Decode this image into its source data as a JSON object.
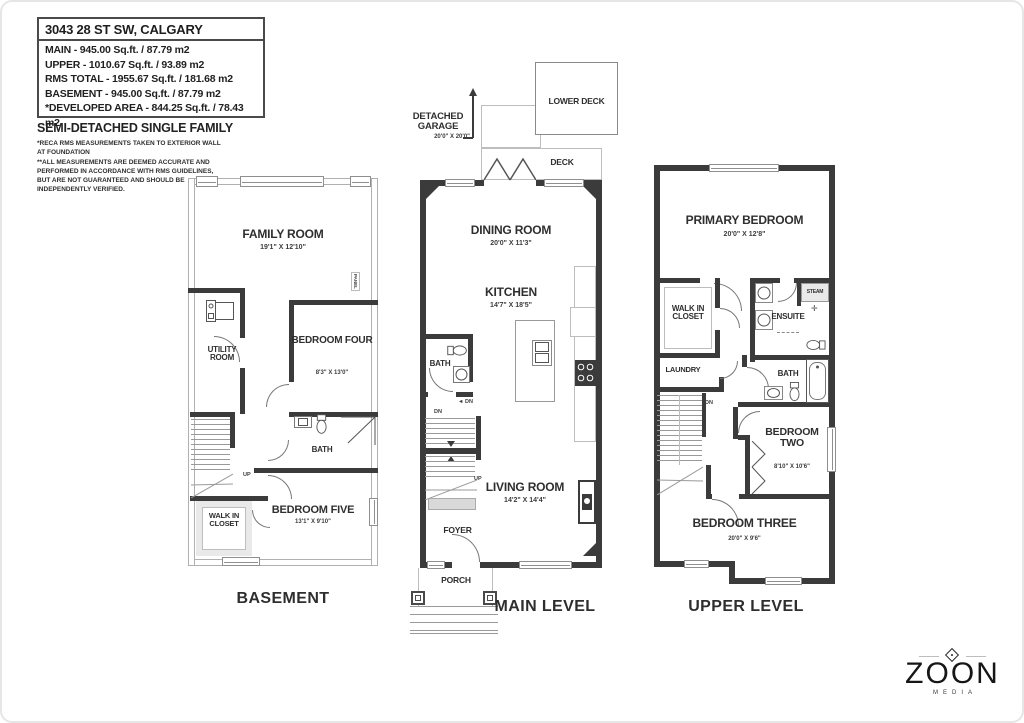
{
  "header": {
    "address": "3043 28 ST SW, CALGARY",
    "area_lines": [
      "MAIN - 945.00 Sq.ft. / 87.79 m2",
      "UPPER - 1010.67 Sq.ft. / 93.89 m2",
      "RMS TOTAL - 1955.67 Sq.ft. / 181.68 m2",
      "BASEMENT - 945.00 Sq.ft. / 87.79 m2",
      "*DEVELOPED AREA - 844.25 Sq.ft. / 78.43 m2"
    ],
    "property_type": "SEMI-DETACHED SINGLE FAMILY",
    "disclaimer_lines": [
      "*RECA RMS MEASUREMENTS TAKEN TO EXTERIOR WALL",
      "AT FOUNDATION",
      "**ALL MEASUREMENTS ARE DEEMED ACCURATE AND",
      "PERFORMED IN ACCORDANCE WITH RMS GUIDELINES,",
      "BUT ARE NOT GUARANTEED AND SHOULD BE",
      "INDEPENDENTLY VERIFIED."
    ]
  },
  "basement": {
    "label": "BASEMENT",
    "family_room": {
      "name": "FAMILY ROOM",
      "dims": "19'1\" X 12'10\""
    },
    "utility_room": {
      "name": "UTILITY ROOM"
    },
    "bedroom_four": {
      "name": "BEDROOM FOUR",
      "dims": "8'3\" X 13'0\""
    },
    "bath": {
      "name": "BATH"
    },
    "walk_in_closet": {
      "name": "WALK IN CLOSET"
    },
    "bedroom_five": {
      "name": "BEDROOM FIVE",
      "dims": "13'1\" X 9'10\""
    },
    "up_label": "UP",
    "panel_label": "PANEL"
  },
  "main": {
    "label": "MAIN LEVEL",
    "detached_garage": {
      "name": "DETACHED GARAGE",
      "dims": "20'0\" X 20'0\""
    },
    "lower_deck": {
      "name": "LOWER DECK"
    },
    "deck": {
      "name": "DECK"
    },
    "dining_room": {
      "name": "DINING ROOM",
      "dims": "20'0\" X 11'3\""
    },
    "kitchen": {
      "name": "KITCHEN",
      "dims": "14'7\" X 18'5\""
    },
    "bath": {
      "name": "BATH"
    },
    "living_room": {
      "name": "LIVING ROOM",
      "dims": "14'2\" X 14'4\""
    },
    "foyer": {
      "name": "FOYER"
    },
    "porch": {
      "name": "PORCH"
    },
    "up_label": "UP",
    "dn_label": "DN"
  },
  "upper": {
    "label": "UPPER LEVEL",
    "primary_bedroom": {
      "name": "PRIMARY BEDROOM",
      "dims": "20'0\" X 12'8\""
    },
    "walk_in_closet": {
      "name": "WALK IN CLOSET"
    },
    "ensuite": {
      "name": "ENSUITE"
    },
    "steam": {
      "name": "STEAM"
    },
    "laundry": {
      "name": "LAUNDRY"
    },
    "bath": {
      "name": "BATH"
    },
    "bedroom_two": {
      "name": "BEDROOM TWO",
      "dims": "8'10\" X 10'6\""
    },
    "bedroom_three": {
      "name": "BEDROOM THREE",
      "dims": "20'0\" X 9'6\""
    },
    "dn_label": "DN"
  },
  "logo": {
    "brand": "ZOON",
    "sub": "MEDIA"
  }
}
